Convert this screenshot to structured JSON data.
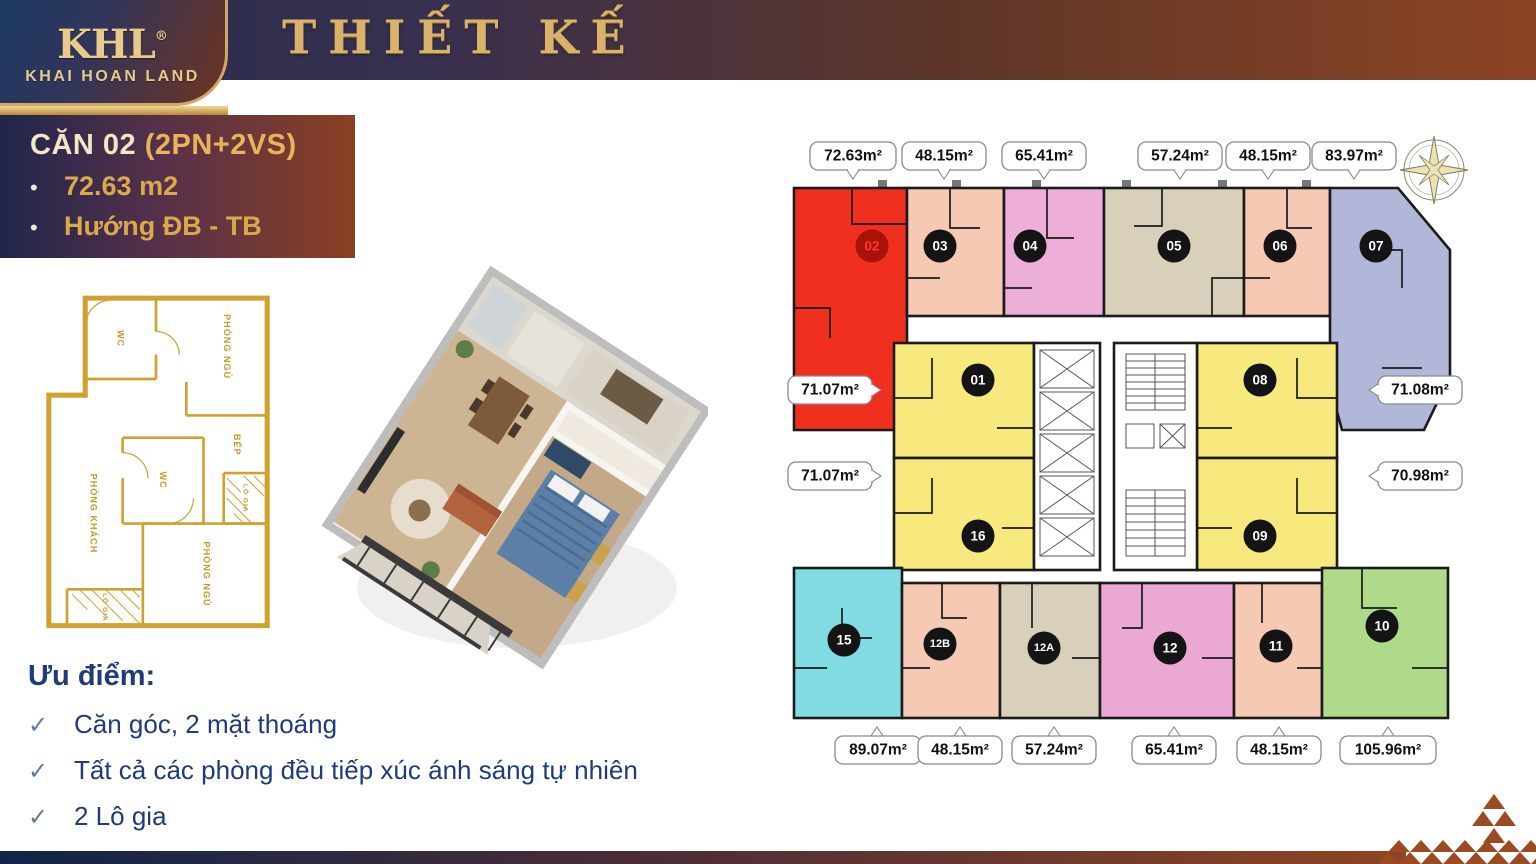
{
  "header": {
    "logo_monogram": "KHL",
    "logo_registered": "®",
    "logo_company": "KHAI HOAN LAND",
    "title": "THIẾT KẾ"
  },
  "info_card": {
    "heading": "CĂN 02 ",
    "heading_suffix": "(2PN+2VS)",
    "bullet_char": "•",
    "bullets": [
      "72.63 m2",
      "Hướng ĐB - TB"
    ]
  },
  "advantages": {
    "heading": "Ưu điểm:",
    "check_char": "✓",
    "items": [
      "Căn góc, 2 mặt thoáng",
      "Tất cả các phòng đều tiếp xúc ánh sáng tự nhiên",
      "2 Lô gia"
    ]
  },
  "plan2d": {
    "rooms": [
      "WC",
      "PHÒNG NGỦ",
      "BẾP",
      "WC",
      "LÔ GIA",
      "PHÒNG KHÁCH",
      "PHÒNG NGỦ",
      "LÔ GIA"
    ]
  },
  "floorplate": {
    "compass_label": "B",
    "units": [
      {
        "id": "02",
        "area": "72.63m²",
        "color": "#f0301f",
        "badge_bg": "#a81208",
        "badge_text": "#ff3b2a"
      },
      {
        "id": "03",
        "area": "48.15m²",
        "color": "#f6c9b4",
        "badge_bg": "#141414",
        "badge_text": "#ffffff"
      },
      {
        "id": "04",
        "area": "65.41m²",
        "color": "#edaed7",
        "badge_bg": "#141414",
        "badge_text": "#ffffff"
      },
      {
        "id": "05",
        "area": "57.24m²",
        "color": "#d8d0bb",
        "badge_bg": "#141414",
        "badge_text": "#ffffff"
      },
      {
        "id": "06",
        "area": "48.15m²",
        "color": "#f6c9b4",
        "badge_bg": "#141414",
        "badge_text": "#ffffff"
      },
      {
        "id": "07",
        "area": "83.97m²",
        "color": "#b2b6d9",
        "badge_bg": "#141414",
        "badge_text": "#ffffff"
      },
      {
        "id": "01",
        "area": "71.07m²",
        "color": "#f7e97d",
        "badge_bg": "#141414",
        "badge_text": "#ffffff"
      },
      {
        "id": "08",
        "area": "71.08m²",
        "color": "#f7e97d",
        "badge_bg": "#141414",
        "badge_text": "#ffffff"
      },
      {
        "id": "16",
        "area": "71.07m²",
        "color": "#f7e97d",
        "badge_bg": "#141414",
        "badge_text": "#ffffff"
      },
      {
        "id": "09",
        "area": "70.98m²",
        "color": "#f7e97d",
        "badge_bg": "#141414",
        "badge_text": "#ffffff"
      },
      {
        "id": "15",
        "area": "89.07m²",
        "color": "#82dce3",
        "badge_bg": "#141414",
        "badge_text": "#ffffff"
      },
      {
        "id": "12B",
        "area": "48.15m²",
        "color": "#f6c9b4",
        "badge_bg": "#141414",
        "badge_text": "#ffffff"
      },
      {
        "id": "12A",
        "area": "57.24m²",
        "color": "#d8d0bb",
        "badge_bg": "#141414",
        "badge_text": "#ffffff"
      },
      {
        "id": "12",
        "area": "65.41m²",
        "color": "#eba8d3",
        "badge_bg": "#141414",
        "badge_text": "#ffffff"
      },
      {
        "id": "11",
        "area": "48.15m²",
        "color": "#f6c9b4",
        "badge_bg": "#141414",
        "badge_text": "#ffffff"
      },
      {
        "id": "10",
        "area": "105.96m²",
        "color": "#aeda8a",
        "badge_bg": "#141414",
        "badge_text": "#ffffff"
      }
    ]
  },
  "colors": {
    "accent_gold": "#d9b36b",
    "navy": "#20264b",
    "rust": "#8a4022",
    "text_navy": "#1f3c78",
    "triangle": "#9c4a21"
  }
}
